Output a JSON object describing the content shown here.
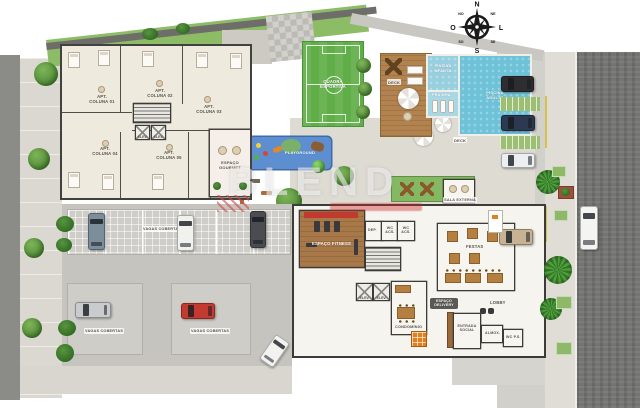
{
  "compass": {
    "north": "N",
    "south": "S",
    "east": "L",
    "west": "O",
    "northwest": "NO",
    "northeast": "NE",
    "southwest": "SO",
    "southeast": "SE"
  },
  "watermark": {
    "text": "BLEND"
  },
  "building_a": {
    "units": [
      {
        "label": "APT.\nCOLUNA 01"
      },
      {
        "label": "APT.\nCOLUNA 02"
      },
      {
        "label": "APT.\nCOLUNA 03"
      },
      {
        "label": "APT.\nCOLUNA 04"
      },
      {
        "label": "APT.\nCOLUNA 05"
      }
    ],
    "gourmet_label": "ESPAÇO\nGOURMET"
  },
  "amenities": {
    "sports_court": "QUADRA ESPORTIVA",
    "deck": "DECK",
    "kids_pool": "PISCINA INFANTIL",
    "beach_entry": "PRAINHA",
    "adult_pool": "PISCINA ADULTO",
    "playground": "PLAYGROUND",
    "outdoor_room": "SALA EXTERNA",
    "fitness": "ESPAÇO FITNESS",
    "party_room": "FESTAS",
    "lobby": "LOBBY",
    "condo_office": "CONDOMÍNIO",
    "delivery": "ESPAÇO DELIVERY",
    "dep": "DEP.",
    "wc_acc": "WC ACS.",
    "wc_ps": "WC P.S.",
    "storage": "ALMOX.",
    "social_entrance": "ENTRADA SOCIAL",
    "elevator": "ELEV."
  },
  "parking": {
    "covered": "VAGAS COBERTAS"
  },
  "colors": {
    "field_green": "#5fae47",
    "pool_blue": "#6ec2d8",
    "deck_wood": "#b2834f",
    "playground_blue": "#5d8fd0",
    "grass": "#8cbc66",
    "locker_orange": "#e0801f",
    "car_red": "#c33b30"
  }
}
